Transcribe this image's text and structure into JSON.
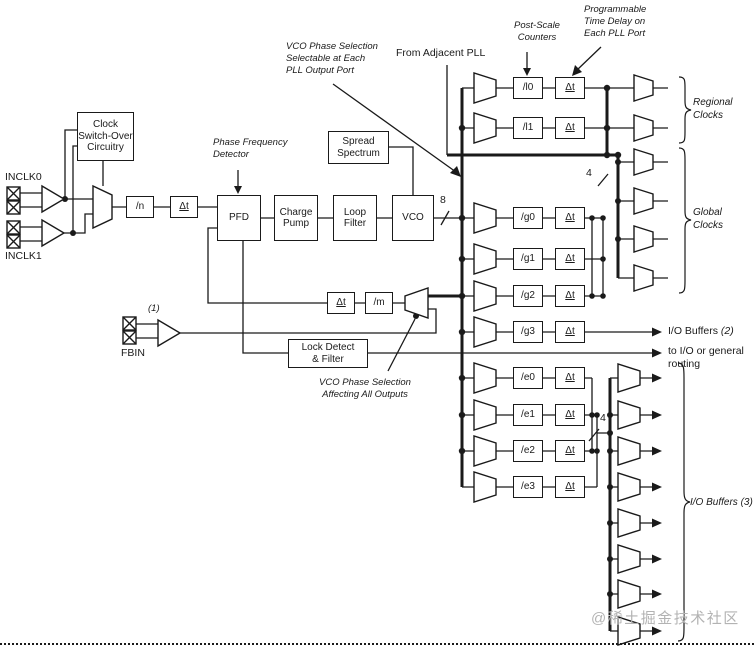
{
  "colors": {
    "line": "#1a1a1a",
    "watermark": "#b3b3b3",
    "background": "#ffffff"
  },
  "inputs": {
    "inclk0": "INCLK0",
    "inclk1": "INCLK1",
    "fbin": "FBIN",
    "fbin_note": "(1)"
  },
  "blocks": {
    "clock_switchover": "Clock\nSwitch-Over\nCircuitry",
    "n_counter": "/n",
    "pfd": "PFD",
    "charge_pump": "Charge\nPump",
    "loop_filter": "Loop\nFilter",
    "vco": "VCO",
    "spread_spectrum": "Spread\nSpectrum",
    "m_counter": "/m",
    "lock_detect": "Lock Detect\n& Filter"
  },
  "labels": {
    "dt": "Δt",
    "bus8": "8",
    "bus4_global": "4",
    "bus4_external": "4"
  },
  "counters": {
    "l": [
      "/l0",
      "/l1"
    ],
    "g": [
      "/g0",
      "/g1",
      "/g2",
      "/g3"
    ],
    "e": [
      "/e0",
      "/e1",
      "/e2",
      "/e3"
    ]
  },
  "annotations": {
    "post_scale": "Post-Scale\nCounters",
    "prog_delay": "Programmable\nTime Delay on\nEach PLL Port",
    "vco_phase_out": "VCO Phase Selection\nSelectable at Each\nPLL Output Port",
    "from_adjacent": "From Adjacent PLL",
    "pfd_label": "Phase Frequency\nDetector",
    "vco_phase_all": "VCO Phase Selection\nAffecting All Outputs",
    "regional_clocks": "Regional\nClocks",
    "global_clocks": "Global\nClocks",
    "io_buffers2": "I/O Buffers",
    "io_buffers2_num": "(2)",
    "io_routing": "to I/O or general\nrouting",
    "io_buffers3": "I/O Buffers (3)"
  },
  "watermark": "@稀土掘金技术社区"
}
